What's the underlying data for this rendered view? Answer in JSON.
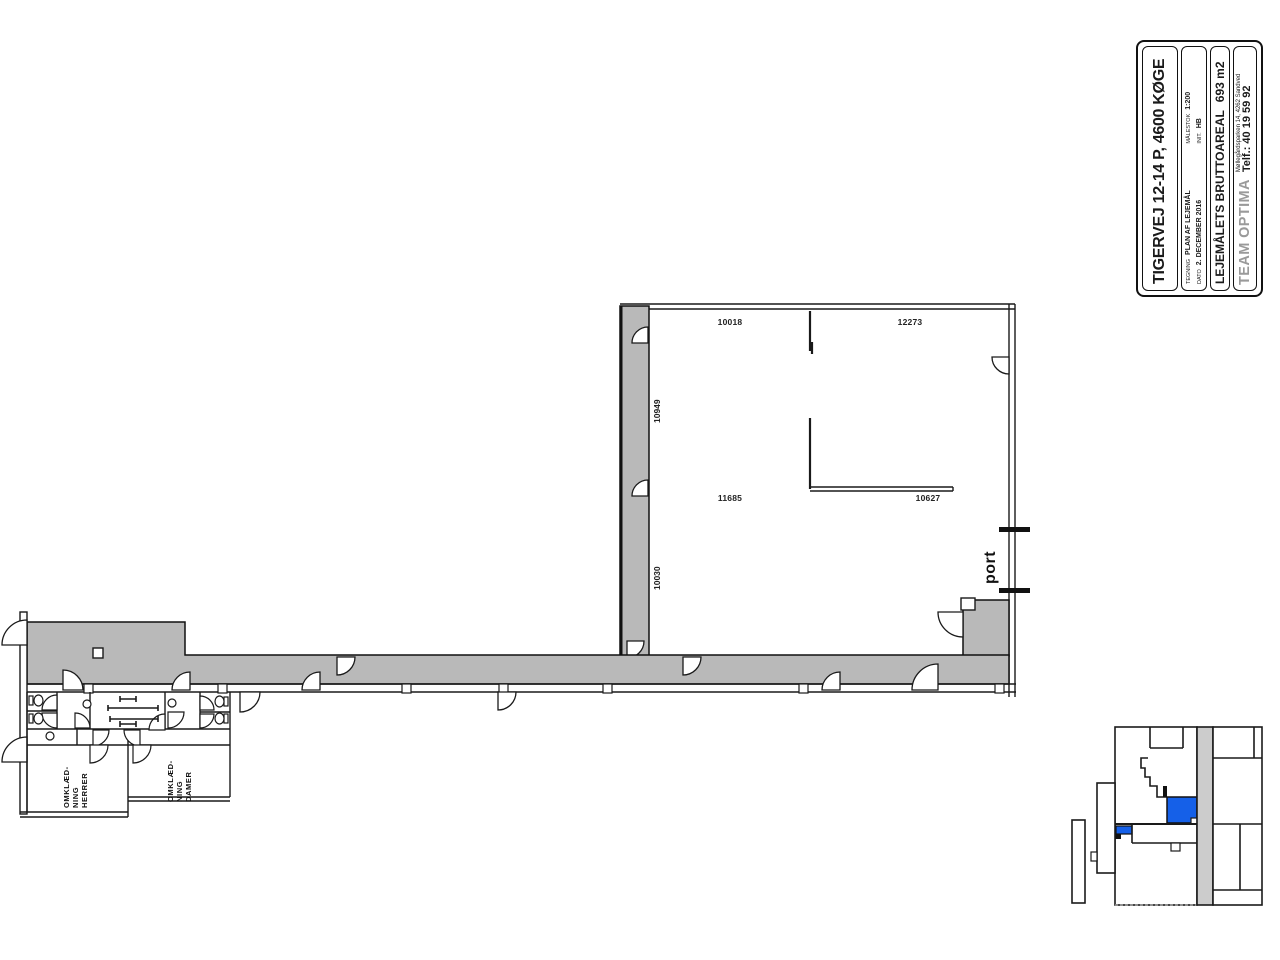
{
  "colors": {
    "wall_gray": "#b9b9b9",
    "keyplan_gray": "#cccccc",
    "highlight_blue": "#1560e8",
    "line": "#1a1a1a"
  },
  "title_block": {
    "title": "TIGERVEJ 12-14 P, 4600 KØGE",
    "tegning_label": "TEGNING",
    "tegning_value": "PLAN AF LEJEMÅL",
    "maalestok_label": "MÅLESTOK",
    "maalestok_value": "1:200",
    "dato_label": "DATO",
    "dato_value": "2. DECEMBER 2016",
    "init_label": "INIT.",
    "init_value": "HB",
    "area_label": "LEJEMÅLETS BRUTTOAREAL",
    "area_value": "693 m2",
    "company": "TEAM OPTIMA",
    "address": "Møllegårdsparken 14, 4262 Sandved",
    "phone": "Telf.: 40 19 59 92"
  },
  "plan": {
    "dim_top_left": "10018",
    "dim_top_right": "12273",
    "dim_left_upper": "10949",
    "dim_left_lower": "10030",
    "dim_mid_left": "11685",
    "dim_mid_right": "10627",
    "port_label": "port",
    "locker_men_line1": "OMKLÆD-",
    "locker_men_line2": "NING",
    "locker_men_line3": "HERRER",
    "locker_women_line1": "OMKLÆD-",
    "locker_women_line2": "NING",
    "locker_women_line3": "DAMER"
  }
}
